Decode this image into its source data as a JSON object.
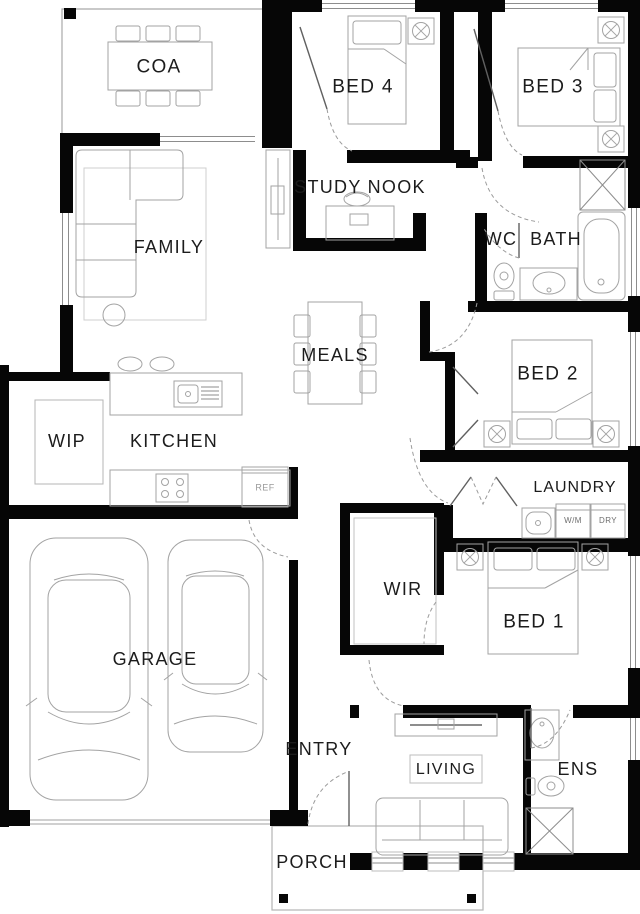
{
  "plan": {
    "type": "residential-floor-plan",
    "colors": {
      "wall": "#060606",
      "furniture_line": "#a3a3a3",
      "light_line": "#c9c9c9",
      "door_line": "#606060",
      "dashed_door": "#9b9b9b",
      "text": "#1c1c1c",
      "muted_text": "#6e6e6e",
      "background": "#ffffff"
    },
    "rooms": {
      "coa": {
        "label": "COA"
      },
      "bed4": {
        "label": "BED 4"
      },
      "bed3": {
        "label": "BED 3"
      },
      "study_nook": {
        "label": "STUDY NOOK"
      },
      "family": {
        "label": "FAMILY"
      },
      "wc": {
        "label": "WC"
      },
      "bath": {
        "label": "BATH"
      },
      "meals": {
        "label": "MEALS"
      },
      "bed2": {
        "label": "BED 2"
      },
      "wip": {
        "label": "WIP"
      },
      "kitchen": {
        "label": "KITCHEN"
      },
      "laundry": {
        "label": "LAUNDRY"
      },
      "wir": {
        "label": "WIR"
      },
      "bed1": {
        "label": "BED 1"
      },
      "garage": {
        "label": "GARAGE"
      },
      "entry": {
        "label": "ENTRY"
      },
      "living": {
        "label": "LIVING"
      },
      "ens": {
        "label": "ENS"
      },
      "porch": {
        "label": "PORCH"
      }
    },
    "fixtures": {
      "fridge": {
        "label": "REF"
      },
      "washing_machine": {
        "label": "W/M"
      },
      "dryer": {
        "label": "DRY"
      }
    }
  }
}
